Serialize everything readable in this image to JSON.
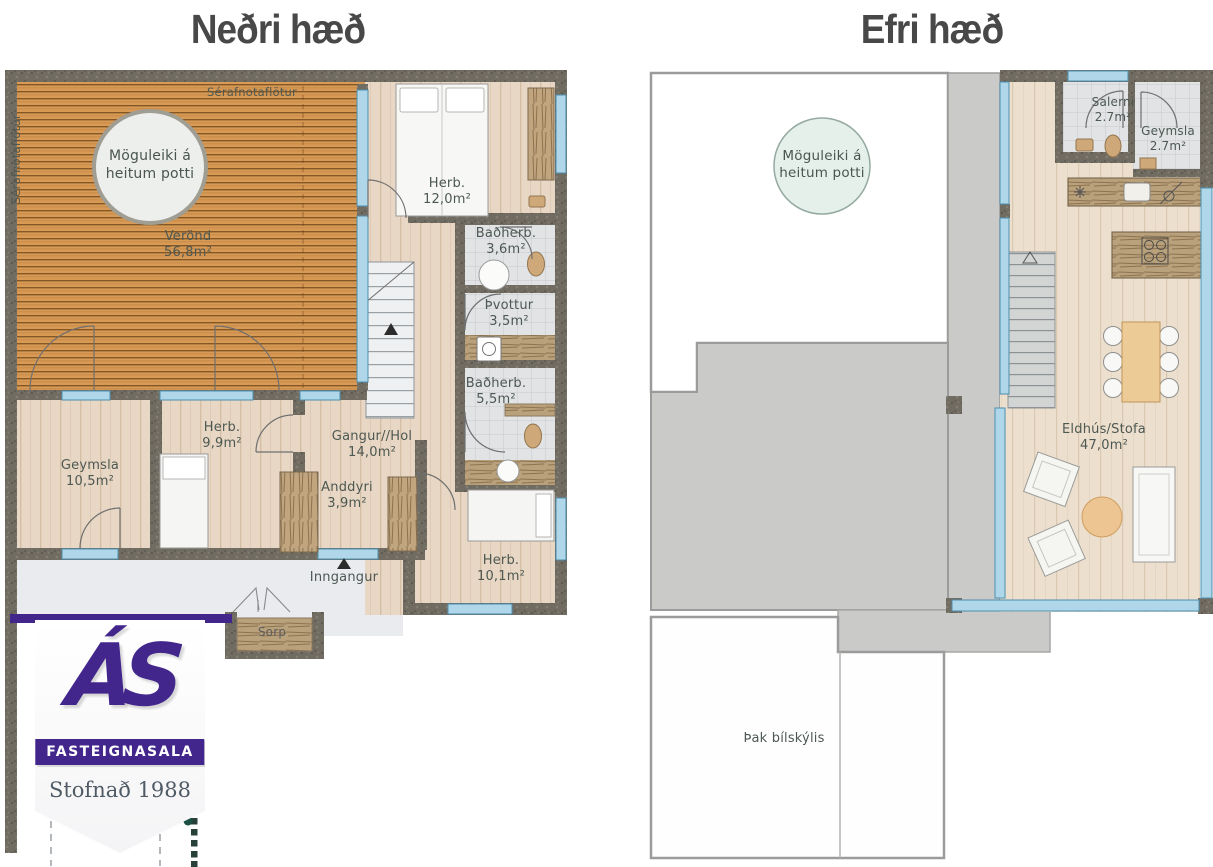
{
  "titles": {
    "lower": "Neðri hæð",
    "upper": "Efri hæð"
  },
  "lower_floor": {
    "exclusive_use_top": "Sérafnotaflötur",
    "exclusive_use_side": "Sérafnotaflötur",
    "hot_tub_circle": "Möguleiki á heitum potti",
    "deck": {
      "name": "Verönd",
      "area": "56,8m²"
    },
    "rooms": [
      {
        "name": "Herb.",
        "area": "12,0m²"
      },
      {
        "name": "Baðherb.",
        "area": "3,6m²"
      },
      {
        "name": "Þvottur",
        "area": "3,5m²"
      },
      {
        "name": "Baðherb.",
        "area": "5,5m²"
      },
      {
        "name": "Gangur//Hol",
        "area": "14,0m²"
      },
      {
        "name": "Herb.",
        "area": "9,9m²"
      },
      {
        "name": "Geymsla",
        "area": "10,5m²"
      },
      {
        "name": "Anddyri",
        "area": "3,9m²"
      },
      {
        "name": "Herb.",
        "area": "10,1m²"
      }
    ],
    "entrance": "Inngangur",
    "waste": "Sorp"
  },
  "upper_floor": {
    "hot_tub_circle": "Möguleiki á heitum potti",
    "rooms": [
      {
        "name": "Salerni",
        "area": "2.7m²"
      },
      {
        "name": "Geymsla",
        "area": "2.7m²"
      },
      {
        "name": "Eldhús/Stofa",
        "area": "47,0m²"
      }
    ],
    "carport_roof": "Þak bílskýlis"
  },
  "agency": {
    "initials": "ÁS",
    "banner": "FASTEIGNASALA",
    "established": "Stofnað 1988"
  },
  "colors": {
    "brand_purple": "#42268c",
    "deck_wood": "#d89a55",
    "interior_floor": "#e7d7c4",
    "wall": "#716c62",
    "window_blue": "#b0d7e9",
    "terrace_gray": "#cacac8",
    "hot_tub_mint": "#e5f0ea"
  }
}
